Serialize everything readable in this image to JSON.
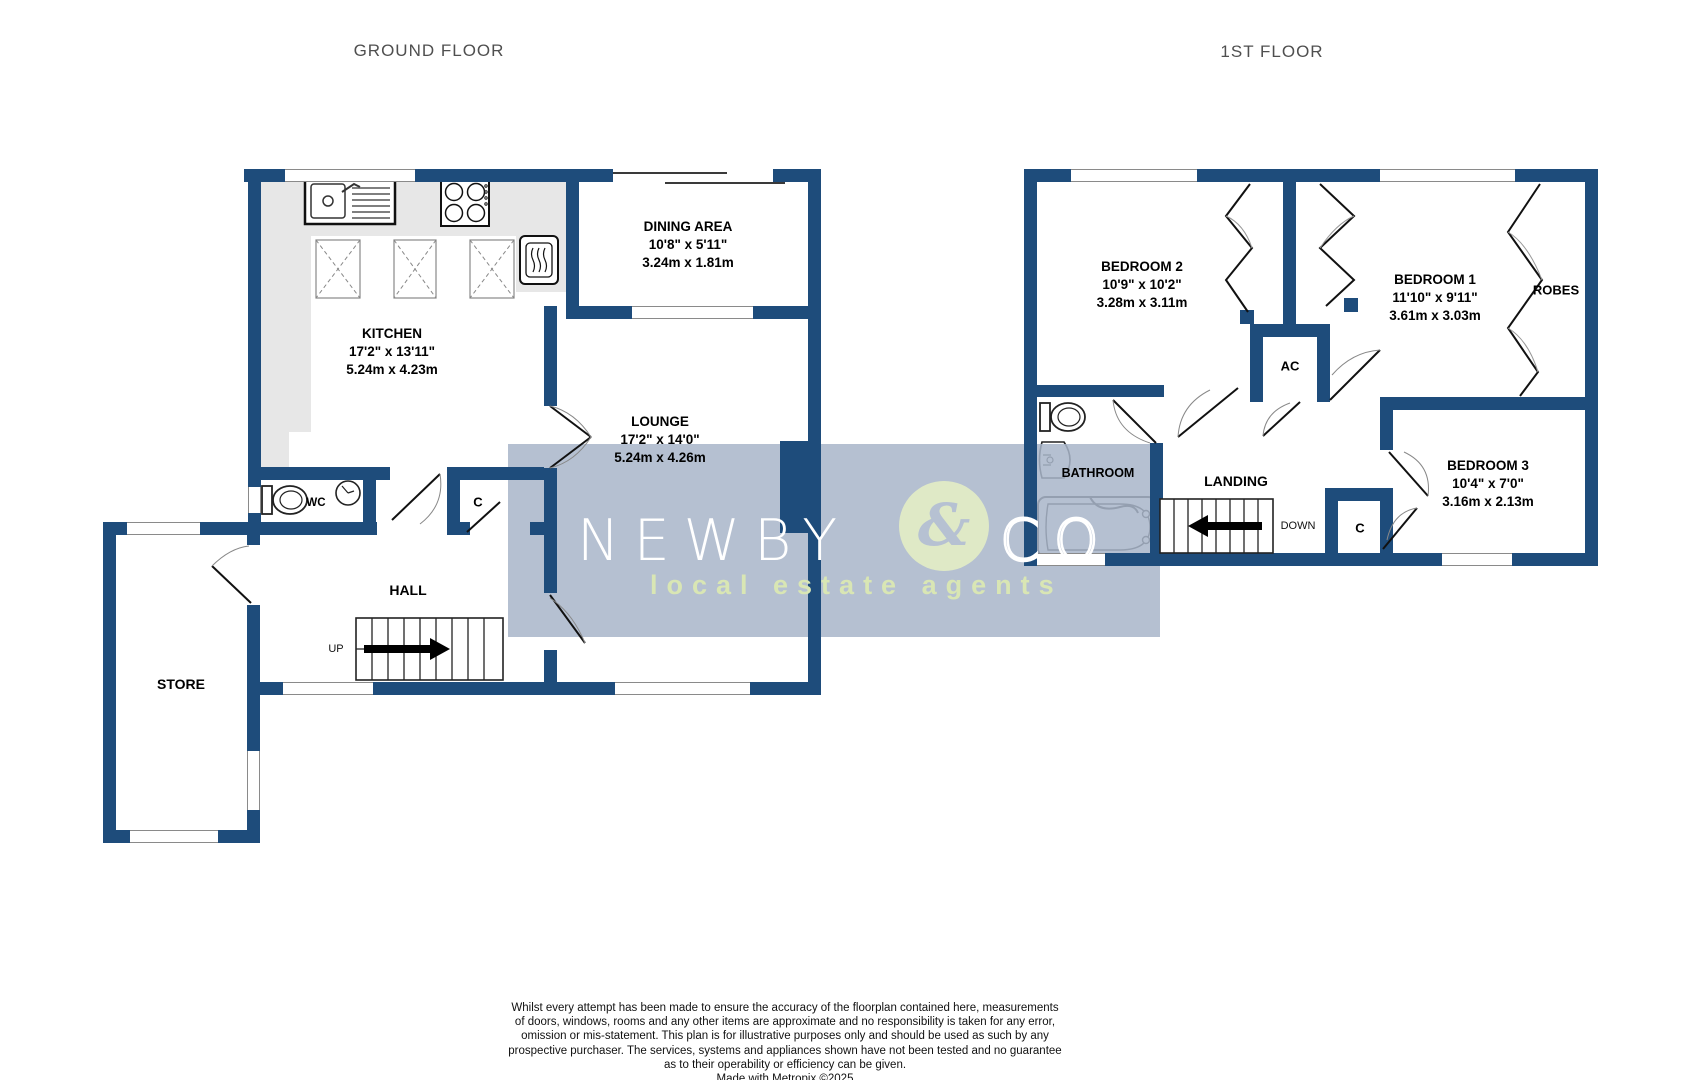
{
  "titles": {
    "ground": "GROUND FLOOR",
    "first": "1ST FLOOR"
  },
  "ground": {
    "rooms": {
      "kitchen": {
        "name": "KITCHEN",
        "imperial": "17'2\"  x 13'11\"",
        "metric": "5.24m  x 4.23m"
      },
      "dining": {
        "name": "DINING AREA",
        "imperial": "10'8\"  x 5'11\"",
        "metric": "3.24m  x 1.81m"
      },
      "lounge": {
        "name": "LOUNGE",
        "imperial": "17'2\"  x 14'0\"",
        "metric": "5.24m  x 4.26m"
      },
      "hall": {
        "name": "HALL"
      },
      "store": {
        "name": "STORE"
      },
      "wc": {
        "name": "WC"
      },
      "cupboard": {
        "name": "C"
      }
    },
    "stairs_label": "UP"
  },
  "first": {
    "rooms": {
      "bedroom1": {
        "name": "BEDROOM 1",
        "imperial": "11'10\"  x 9'11\"",
        "metric": "3.61m  x 3.03m"
      },
      "bedroom2": {
        "name": "BEDROOM 2",
        "imperial": "10'9\"  x 10'2\"",
        "metric": "3.28m  x 3.11m"
      },
      "bedroom3": {
        "name": "BEDROOM 3",
        "imperial": "10'4\"  x 7'0\"",
        "metric": "3.16m  x 2.13m"
      },
      "bathroom": {
        "name": "BATHROOM"
      },
      "landing": {
        "name": "LANDING"
      },
      "robes": {
        "name": "ROBES"
      },
      "airing": {
        "name": "AC"
      },
      "cupboard": {
        "name": "C"
      }
    },
    "stairs_label": "DOWN"
  },
  "watermark": {
    "word1": "NEWBY",
    "ampersand": "&",
    "word2": "CO",
    "tagline": "local estate agents"
  },
  "disclaimer": {
    "lines": [
      "Whilst every attempt has been made to ensure the accuracy of the floorplan contained here, measurements",
      "of doors, windows, rooms and any other items are approximate and no responsibility is taken for any error,",
      "omission or mis-statement. This plan is for illustrative purposes only and should be used as such by any",
      "prospective purchaser. The services, systems and appliances shown have not been tested and no guarantee",
      "as to their operability or efficiency can be given.",
      "Made with Metropix ©2025"
    ]
  },
  "colors": {
    "wall_navy": "#1e4c7b",
    "watermark_bg": "#b5c0d1",
    "watermark_circle_green": "#dfe9c6",
    "watermark_text_green": "#d9e6b4",
    "counter_gray": "#e7e7e7",
    "title_gray": "#4f4f4f"
  }
}
